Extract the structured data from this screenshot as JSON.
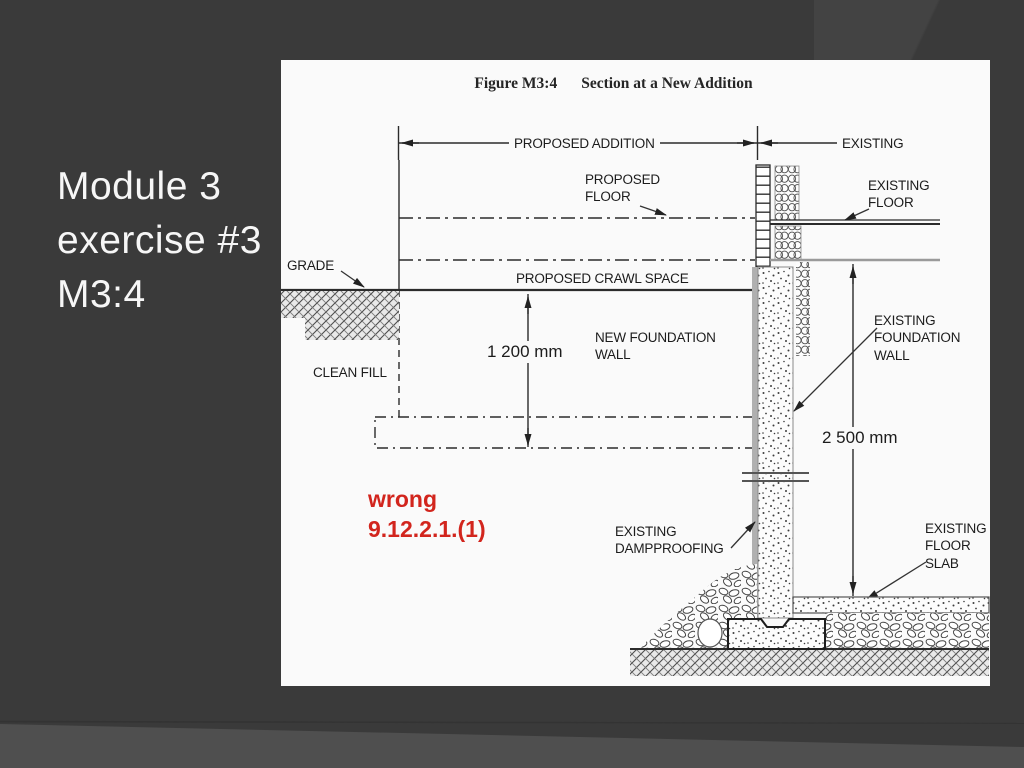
{
  "slide": {
    "title": "Module 3\nexercise #3\nM3:4"
  },
  "figure": {
    "caption_label": "Figure M3:4",
    "caption_title": "Section at a New Addition",
    "dim_proposed_addition": "PROPOSED ADDITION",
    "dim_existing": "EXISTING",
    "dim_wall_height": "1 200 mm",
    "dim_foundation_height": "2 500 mm",
    "label_proposed_floor": "PROPOSED\nFLOOR",
    "label_existing_floor": "EXISTING\nFLOOR",
    "label_grade": "GRADE",
    "label_crawl_space": "PROPOSED CRAWL SPACE",
    "label_new_foundation_wall": "NEW FOUNDATION\nWALL",
    "label_clean_fill": "CLEAN FILL",
    "label_existing_foundation_wall": "EXISTING\nFOUNDATION\nWALL",
    "label_existing_dampproofing": "EXISTING\nDAMPPROOFING",
    "label_existing_floor_slab": "EXISTING\nFLOOR\nSLAB",
    "annotation_wrong": "wrong\n9.12.2.1.(1)"
  },
  "colors": {
    "annotation_red": "#d2251d",
    "slide_background": "#3a3a3a",
    "panel_background": "#fafafa",
    "line_ink": "#2b2b2b"
  }
}
